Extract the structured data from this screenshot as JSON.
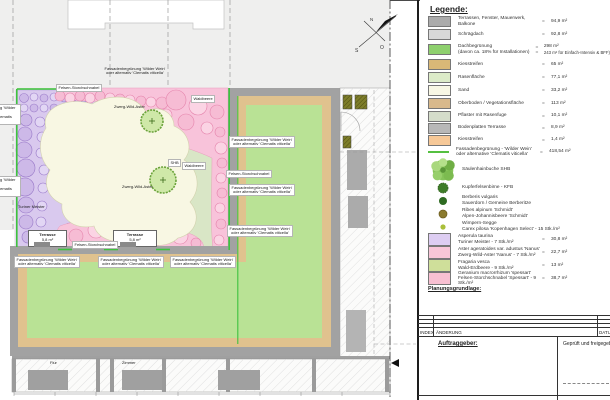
{
  "plan": {
    "compass": {
      "n": "N",
      "s": "S",
      "o": "O"
    },
    "labels": {
      "fassade1": "Fassadenbegrünung 'Wilder Wein'",
      "fassade2": "oder alternativ 'Clematis viticella'",
      "felsen": "Felsen-Storchschnabel",
      "zwerg": "Zwerg-Wild-Aster",
      "turiner": "Turiner Meister",
      "waldbeere": "Waldbeere",
      "shb": "SHB",
      "terrasse": "Terrasse",
      "terrasse_area": "5,8 m²",
      "flur": "Flur",
      "zimmer": "Zimmer"
    }
  },
  "legend": {
    "title": "Legende:",
    "eq": "=",
    "areas": [
      {
        "color": "#ababab",
        "label": "Terrassen, Fenster, Mauerwerk, Balkone",
        "value": "94,9 m²"
      },
      {
        "color": "#d8d8d8",
        "label": "Schrägdach",
        "value": "92,8 m²"
      },
      {
        "color": "#8ed06e",
        "label": "Dachbegrünung",
        "label2": "(davon ca. 18% für Installationen)",
        "value": "298 m²",
        "value2": "243 m² für Einfach-Intensiv & BFF)"
      },
      {
        "color": "#d9b877",
        "label": "Kiesstreifen",
        "value": "65 m²"
      },
      {
        "color": "#dcebc8",
        "label": "Rasenfläche",
        "value": "77,1 m²"
      },
      {
        "color": "#f8f7e4",
        "label": "Sand",
        "value": "33,2 m²"
      },
      {
        "color": "#d8b98c",
        "label": "Oberboden / Vegetationsfläche",
        "value": "113 m²"
      },
      {
        "color": "#d4dcca",
        "label": "Pflaster mit Rasenfuge",
        "value": "10,1 m²"
      },
      {
        "color": "#b8b8b8",
        "label": "Bodenplatten Terrasse",
        "value": "8,9 m²"
      },
      {
        "color": "#f6c897",
        "label": "Kiesstreifen",
        "value": "1,4 m²"
      }
    ],
    "fassade_row": {
      "line_color": "#55c040",
      "label1": "Fassadenbegrünung - 'Wilder Wein'",
      "label2": "oder alternative 'Clematis viticella'",
      "value": "418,54 m²"
    },
    "woody_plants": [
      {
        "label": "Säulenhainbuche SHB"
      },
      {
        "label": "Kupferfelsenbirne - KFB"
      },
      {
        "label1": "Berberis vulgaris",
        "label2": "Sauerdorn / Gemeine Berberitze"
      },
      {
        "label1": "Ribes alpinum 'Schmidt'",
        "label2": "Alpen-Johannisbeere 'Schmidt'"
      },
      {
        "label1": "Wimpern-Segge",
        "label2": "Carex pilosa 'Kopenhagen Select' - 15 Stk./m²"
      }
    ],
    "perennials": [
      {
        "color": "#ddcdf2",
        "label1": "Asperula taurina",
        "label2": "Turiner Meister - 7 Stk./m²",
        "value": "30,8 m²"
      },
      {
        "color": "#f8c6d8",
        "label1": "Aster ageratoides var. adustus 'Nanus'",
        "label2": "Zwerg-Wild-Aster 'Nanus' - 7 Stk./m²",
        "value": "22,7 m²"
      },
      {
        "color": "#cfdf9a",
        "label1": "Fragaria vesca",
        "label2": "Wald-Erdbeere - 9 Stk./m²",
        "value": "13 m²"
      },
      {
        "color": "#f8c0d2",
        "label1": "Geranium macrorrhizum 'spessart'",
        "label2": "Felsen-Storchschnabel 'Spessart' - 9 Stk./m²",
        "value": "38,7 m²"
      }
    ],
    "planning_title": "Planungsgrundlage:",
    "titleblock": {
      "index": "INDEX",
      "aenderung": "ÄNDERUNG",
      "datum": "DATUM",
      "client": "Auftraggeber:",
      "approved": "Geprüft und freigegeben:"
    }
  }
}
